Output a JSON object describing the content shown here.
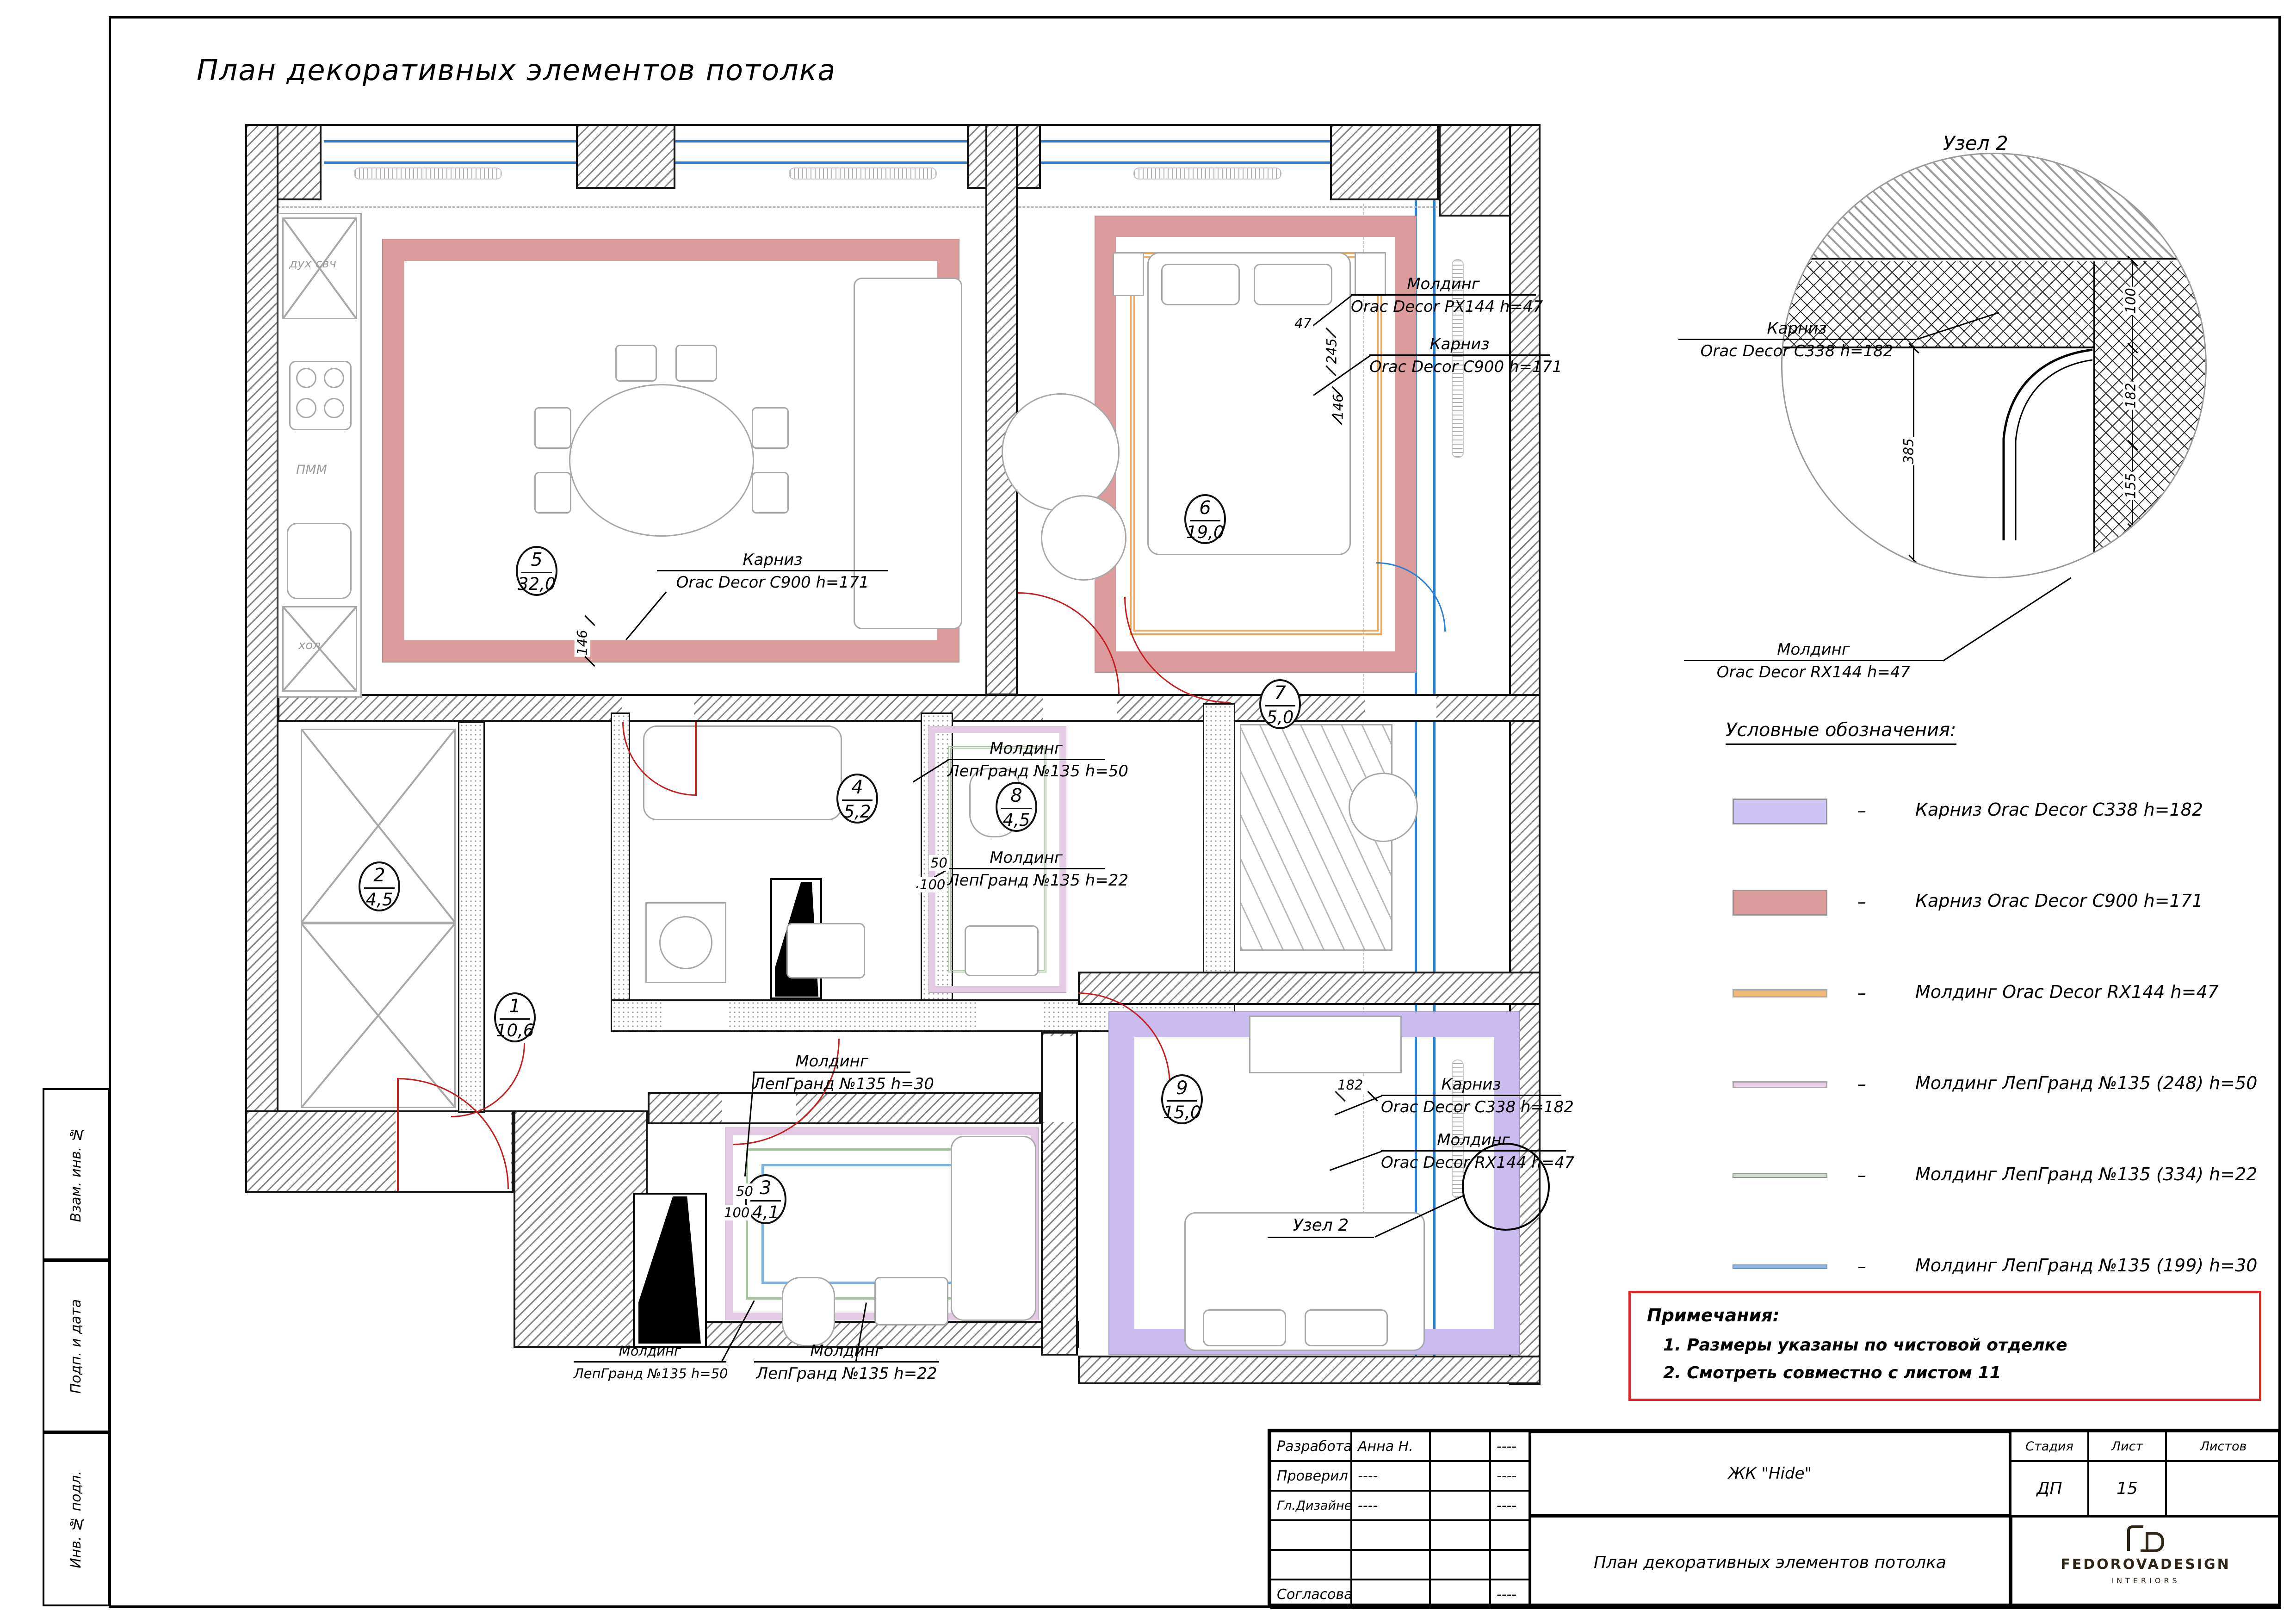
{
  "sheet": {
    "title": "План декоративных элементов потолка"
  },
  "side_strip": {
    "cells": [
      "Взам. инв. №",
      "Подп. и дата",
      "Инв. № подл."
    ]
  },
  "node_detail": {
    "title": "Узел 2",
    "cornice": {
      "line1": "Карниз",
      "line2": "Orac Decor C338 h=182"
    },
    "molding": {
      "line1": "Молдинг",
      "line2": "Orac Decor RX144 h=47"
    },
    "dims": {
      "d100": "100",
      "d182": "182",
      "d155": "155",
      "d47": "47",
      "d385": "385"
    }
  },
  "legend": {
    "title": "Условные обозначения:",
    "dash": "–",
    "items": [
      {
        "label": "Карниз Orac Decor C338 h=182",
        "color": "#cfc5f5"
      },
      {
        "label": "Карниз Orac Decor C900 h=171",
        "color": "#dd9c9c"
      },
      {
        "label": "Молдинг Orac Decor RX144 h=47",
        "color": "#f2bb75"
      },
      {
        "label": "Молдинг ЛепГранд №135 (248) h=50",
        "color": "#e6cfe5"
      },
      {
        "label": "Молдинг ЛепГранд №135 (334) h=22",
        "color": "#b9c6b4"
      },
      {
        "label": "Молдинг ЛепГранд №135 (199) h=30",
        "color": "#8fbce4"
      }
    ]
  },
  "notes": {
    "title": "Примечания:",
    "items": [
      "1.  Размеры указаны по чистовой отделке",
      "2.  Смотреть совместно с листом 11"
    ]
  },
  "rooms": [
    {
      "num": "1",
      "area": "10,6"
    },
    {
      "num": "2",
      "area": "4,5"
    },
    {
      "num": "3",
      "area": "4,1"
    },
    {
      "num": "4",
      "area": "5,2"
    },
    {
      "num": "5",
      "area": "32,0"
    },
    {
      "num": "6",
      "area": "19,0"
    },
    {
      "num": "7",
      "area": "5,0"
    },
    {
      "num": "8",
      "area": "4,5"
    },
    {
      "num": "9",
      "area": "15,0"
    }
  ],
  "annotations": [
    {
      "line1": "Карниз",
      "line2": "Orac Decor C900 h=171"
    },
    {
      "line1": "Молдинг",
      "line2": "Orac Decor PX144 h=47"
    },
    {
      "line1": "Карниз",
      "line2": "Orac Decor C900 h=171"
    },
    {
      "line1": "Молдинг",
      "line2": "ЛепГранд №135 h=50"
    },
    {
      "line1": "Молдинг",
      "line2": "ЛепГранд №135 h=22"
    },
    {
      "line1": "Молдинг",
      "line2": "ЛепГранд №135 h=30"
    },
    {
      "line1": "Карниз",
      "line2": "Orac Decor C338 h=182"
    },
    {
      "line1": "Молдинг",
      "line2": "Orac Decor RX144 h=47"
    },
    {
      "line1": "Молдинг",
      "line2": "ЛепГранд №135 h=50"
    },
    {
      "line1": "Молдинг",
      "line2": "ЛепГранд №135 h=22"
    }
  ],
  "node_ref": {
    "label": "Узел 2"
  },
  "plan_dims": {
    "d146_room5": "146",
    "d47_top": "47",
    "d245_top": "245",
    "d146_top": "146",
    "d182_room9": "182",
    "d50_room8": "50",
    "d100_room8": "100",
    "d50_room3": "50",
    "d100_room3": "100"
  },
  "kitchen": {
    "oven": "дух свч",
    "dishwasher": "ПММ",
    "fridge": "хол"
  },
  "titleblock": {
    "rows": [
      [
        "Разработал",
        "Анна Н.",
        "",
        "----"
      ],
      [
        "Проверил",
        "----",
        "",
        "----"
      ],
      [
        "Гл.Дизайнер",
        "----",
        "",
        "----"
      ],
      [
        "",
        "",
        "",
        ""
      ],
      [
        "",
        "",
        "",
        ""
      ],
      [
        "Согласовано",
        "",
        "",
        "----"
      ]
    ],
    "project": "ЖК \"Hide\"",
    "doc_title": "План декоративных элементов потолка",
    "stage_label": "Стадия",
    "sheet_label": "Лист",
    "sheets_label": "Листов",
    "stage": "ДП",
    "sheet_num": "15",
    "sheets": "",
    "logo_line1": "FEDOROVADESIGN",
    "logo_line2": "INTERIORS"
  }
}
